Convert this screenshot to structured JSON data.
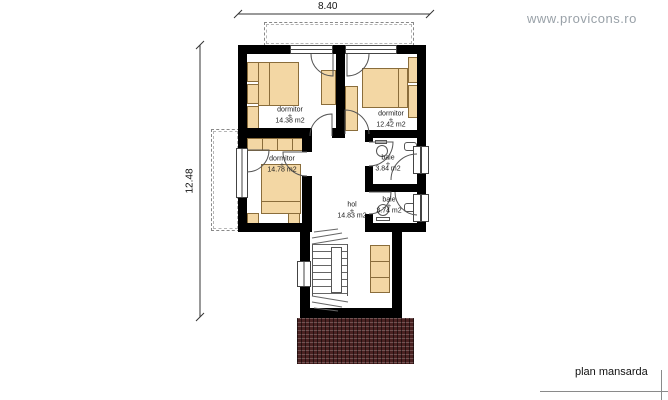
{
  "watermark": "www.provicons.ro",
  "plan_label": "plan mansarda",
  "dimensions": {
    "width": "8.40",
    "height": "12.48"
  },
  "room_marker": "+",
  "rooms": [
    {
      "name": "dormitor",
      "area": "14.38 m2"
    },
    {
      "name": "dormitor",
      "area": "12.42 m2"
    },
    {
      "name": "dormitor",
      "area": "14.78 m2"
    },
    {
      "name": "baie",
      "area": "3.84 m2"
    },
    {
      "name": "baie",
      "area": "3.74 m2"
    },
    {
      "name": "hol",
      "area": "14.83 m2"
    }
  ],
  "colors": {
    "wall": "#000000",
    "furniture": "#f3d7a4",
    "furniture_border": "#8a6d3b",
    "roof_hatch": "#4b2222",
    "watermark_text": "#99a1a8",
    "thin_line": "#555555"
  }
}
